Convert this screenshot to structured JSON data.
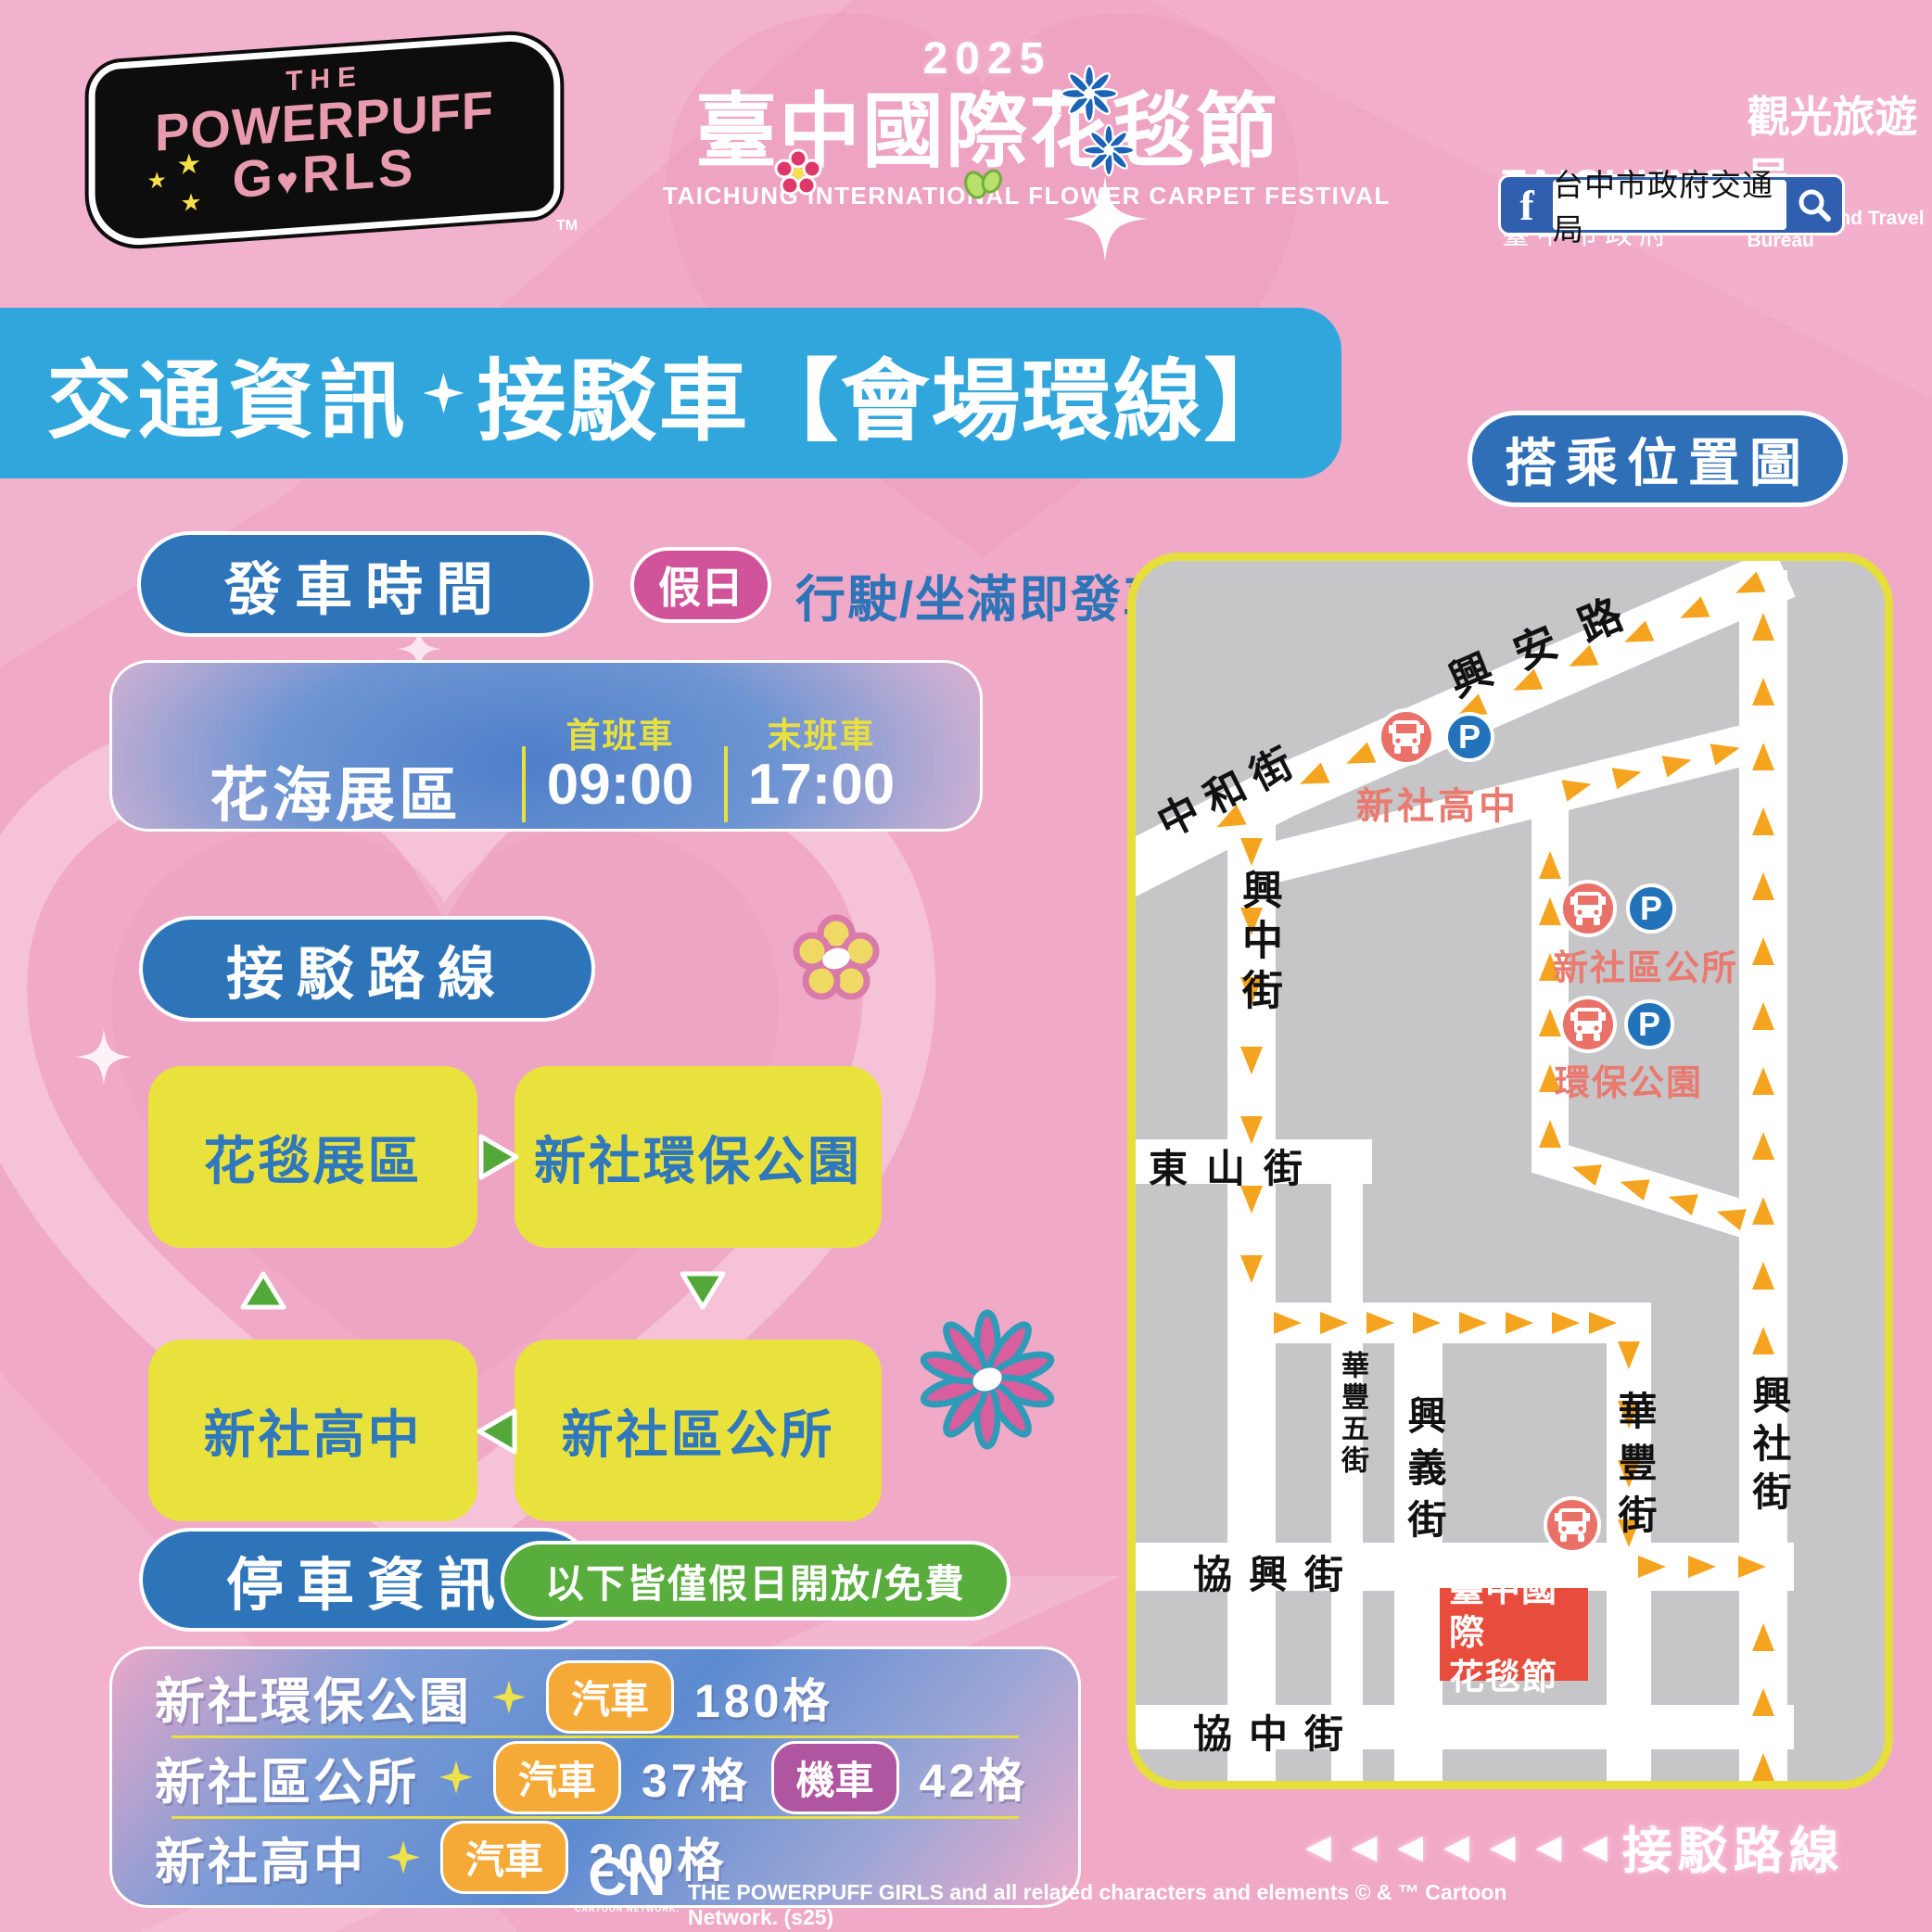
{
  "header": {
    "ppg_logo": {
      "the": "THE",
      "line1": "POWERPUFF",
      "girls_g": "G",
      "girls_rls": "RLS",
      "tm": "TM"
    },
    "festival_logo": {
      "year": "2025",
      "title": "臺中國際花毯節",
      "subtitle": "TAICHUNG INTERNATIONAL FLOWER CARPET FESTIVAL"
    },
    "bureau_logo": {
      "en": "TAICHUNG",
      "bureau": "觀光旅遊局",
      "gov": "臺中市政府",
      "sub": "Tourism and Travel Bureau"
    },
    "facebook_bar": {
      "icon": "f",
      "page_name": "台中市政府交通局"
    }
  },
  "title_banner": {
    "light": "交通資訊",
    "bold": "接駁車【會場環線】"
  },
  "map_badge": "搭乘位置圖",
  "departure": {
    "heading": "發車時間",
    "badge": "假日",
    "note": "行駛/坐滿即發車",
    "table": {
      "station": "花海展區",
      "first_label": "首班車",
      "first_time": "09:00",
      "last_label": "末班車",
      "last_time": "17:00"
    }
  },
  "route": {
    "heading": "接駁路線",
    "stops": [
      "花毯展區",
      "新社環保公園",
      "新社區公所",
      "新社高中"
    ]
  },
  "parking": {
    "heading": "停車資訊",
    "note": "以下皆僅假日開放/免費",
    "rows": [
      {
        "name": "新社環保公園",
        "slots": [
          {
            "type": "汽車",
            "count": "180格"
          }
        ]
      },
      {
        "name": "新社區公所",
        "slots": [
          {
            "type": "汽車",
            "count": "37格"
          },
          {
            "type": "機車",
            "count": "42格"
          }
        ]
      },
      {
        "name": "新社高中",
        "slots": [
          {
            "type": "汽車",
            "count": "200格"
          }
        ]
      }
    ]
  },
  "map": {
    "streets": [
      "興安路",
      "中和街",
      "興中街",
      "東山街",
      "華豐五街",
      "興義街",
      "華豐街",
      "協興街",
      "協中街",
      "興社街"
    ],
    "stops": [
      {
        "name": "新社高中"
      },
      {
        "name": "新社區公所"
      },
      {
        "name": "環保公園"
      }
    ],
    "parking_letter": "P",
    "venue": {
      "line1": "臺中國際",
      "line2": "花毯節"
    },
    "legend_arrows": "◀ ◀ ◀ ◀ ◀ ◀ ◀",
    "legend_label": "接駁路線"
  },
  "footer": {
    "cn": "CN",
    "cn_sub": "CARTOON NETWORK.",
    "copyright": "THE POWERPUFF GIRLS and all related characters and elements © & ™ Cartoon Network. (s25)"
  },
  "colors": {
    "background_pink": "#F0A9C6",
    "banner_blue": "#30A6DC",
    "pill_blue": "#2E74B8",
    "badge_pink": "#D1549B",
    "box_yellow": "#EAE23C",
    "box_text_blue": "#2E78BB",
    "arrow_green": "#53A839",
    "badge_green": "#58AD3C",
    "car_orange": "#F5A937",
    "moto_purple": "#B055A0",
    "map_border_yellow": "#E6DF3B",
    "map_gray": "#C6C5C7",
    "route_arrow_orange": "#F5A41F",
    "bus_red": "#E97168",
    "parking_blue": "#2273BA",
    "stop_label_salmon": "#E97A70",
    "venue_red": "#E84C3D"
  }
}
